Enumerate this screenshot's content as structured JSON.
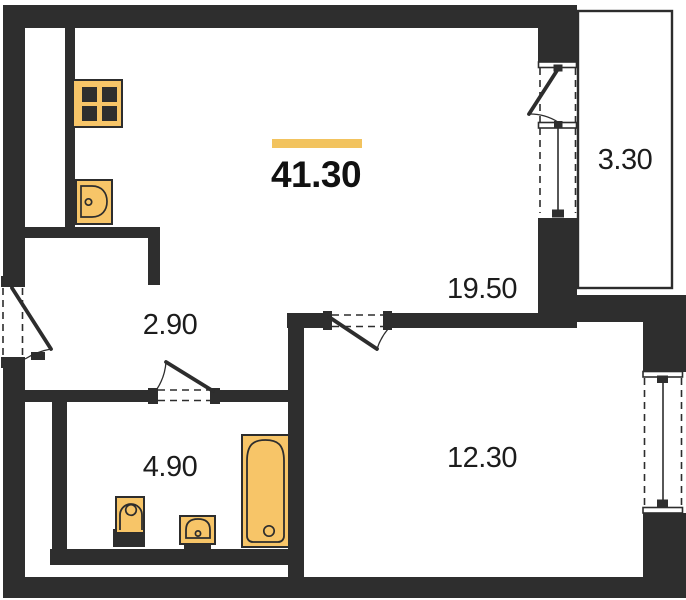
{
  "plan": {
    "type": "apartment-floor-plan",
    "total_area": "41.30"
  },
  "areas": {
    "total": "41.30",
    "living": "19.50",
    "balcony": "3.30",
    "hallway": "2.90",
    "bathroom": "4.90",
    "bedroom": "12.30"
  },
  "rooms": [
    {
      "name": "living-kitchen",
      "area": "19.50"
    },
    {
      "name": "balcony",
      "area": "3.30"
    },
    {
      "name": "hallway",
      "area": "2.90"
    },
    {
      "name": "bathroom",
      "area": "4.90"
    },
    {
      "name": "bedroom",
      "area": "12.30"
    }
  ],
  "fixtures": [
    "stove",
    "kitchen-sink",
    "toilet",
    "washbasin",
    "bathtub"
  ],
  "openings": [
    "entrance-door",
    "bathroom-door",
    "bedroom-door",
    "balcony-door",
    "balcony-window",
    "bedroom-window"
  ],
  "colors": {
    "wall": "#2e2e2e",
    "line": "#2d2d2d",
    "fixture_fill": "#f7c568",
    "accent": "#f2c35e",
    "text": "#1c1c1c",
    "background": "#ffffff"
  }
}
